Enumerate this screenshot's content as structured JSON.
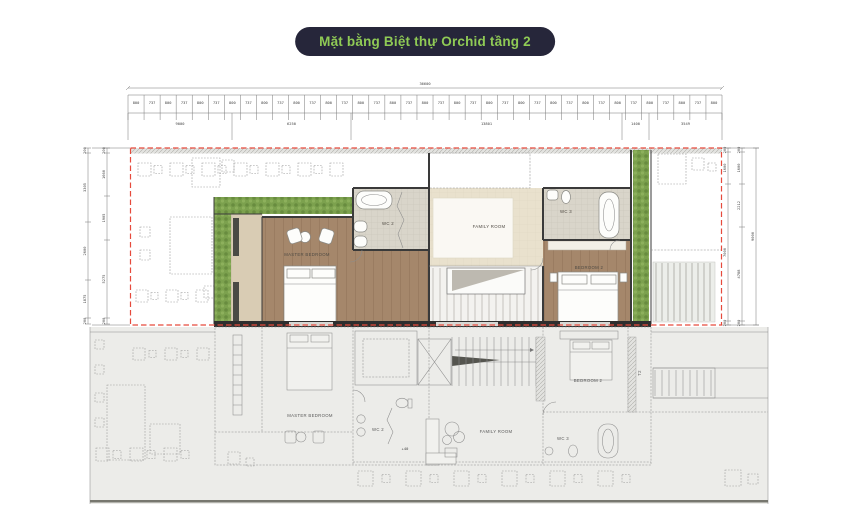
{
  "title": {
    "badge": "Mặt bằng Biệt thự Orchid tầng 2"
  },
  "colors": {
    "badge_bg": "#26263a",
    "badge_text": "#8fca55",
    "highlight_red": "#e64a3c",
    "hedge_green": "#7ca14e",
    "wood_floor": "#a5876b",
    "tile_floor": "#d9d5ca",
    "family_floor": "#e9e1cd",
    "wall_dark": "#2e2e2e",
    "cad_line": "#8c8c8c",
    "lower_bg": "#ecece9"
  },
  "rooms": {
    "master_bedroom": "MASTER BEDROOM",
    "wc2": "WC 2",
    "family_room": "FAMILY ROOM",
    "wc3": "WC 3",
    "bedroom2": "BEDROOM 2",
    "t2": "T2"
  },
  "annotations": {
    "level_mark": "+40"
  },
  "dimensions": {
    "top_overall": "36600",
    "top_small": [
      "800",
      "737",
      "800",
      "737",
      "800",
      "737",
      "800",
      "737",
      "800",
      "737",
      "800",
      "737",
      "800",
      "737",
      "800",
      "737",
      "800",
      "737",
      "800",
      "737",
      "800",
      "737",
      "800",
      "737",
      "800",
      "737",
      "800",
      "737",
      "800",
      "737",
      "800",
      "737",
      "800",
      "737",
      "800",
      "737",
      "800"
    ],
    "top_segments": [
      "9000",
      "6250",
      "13801",
      "1400",
      "3549"
    ],
    "left_outer": [
      "200",
      "3305",
      "2600",
      "1875",
      "200"
    ],
    "left_inner": [
      "200",
      "1660",
      "1905",
      "5275",
      "200"
    ],
    "right_inner": [
      "200",
      "1600",
      "7000",
      "200"
    ],
    "right_middle": [
      "200",
      "1600",
      "2212",
      "4788",
      "200"
    ],
    "right_overall": "9000"
  }
}
